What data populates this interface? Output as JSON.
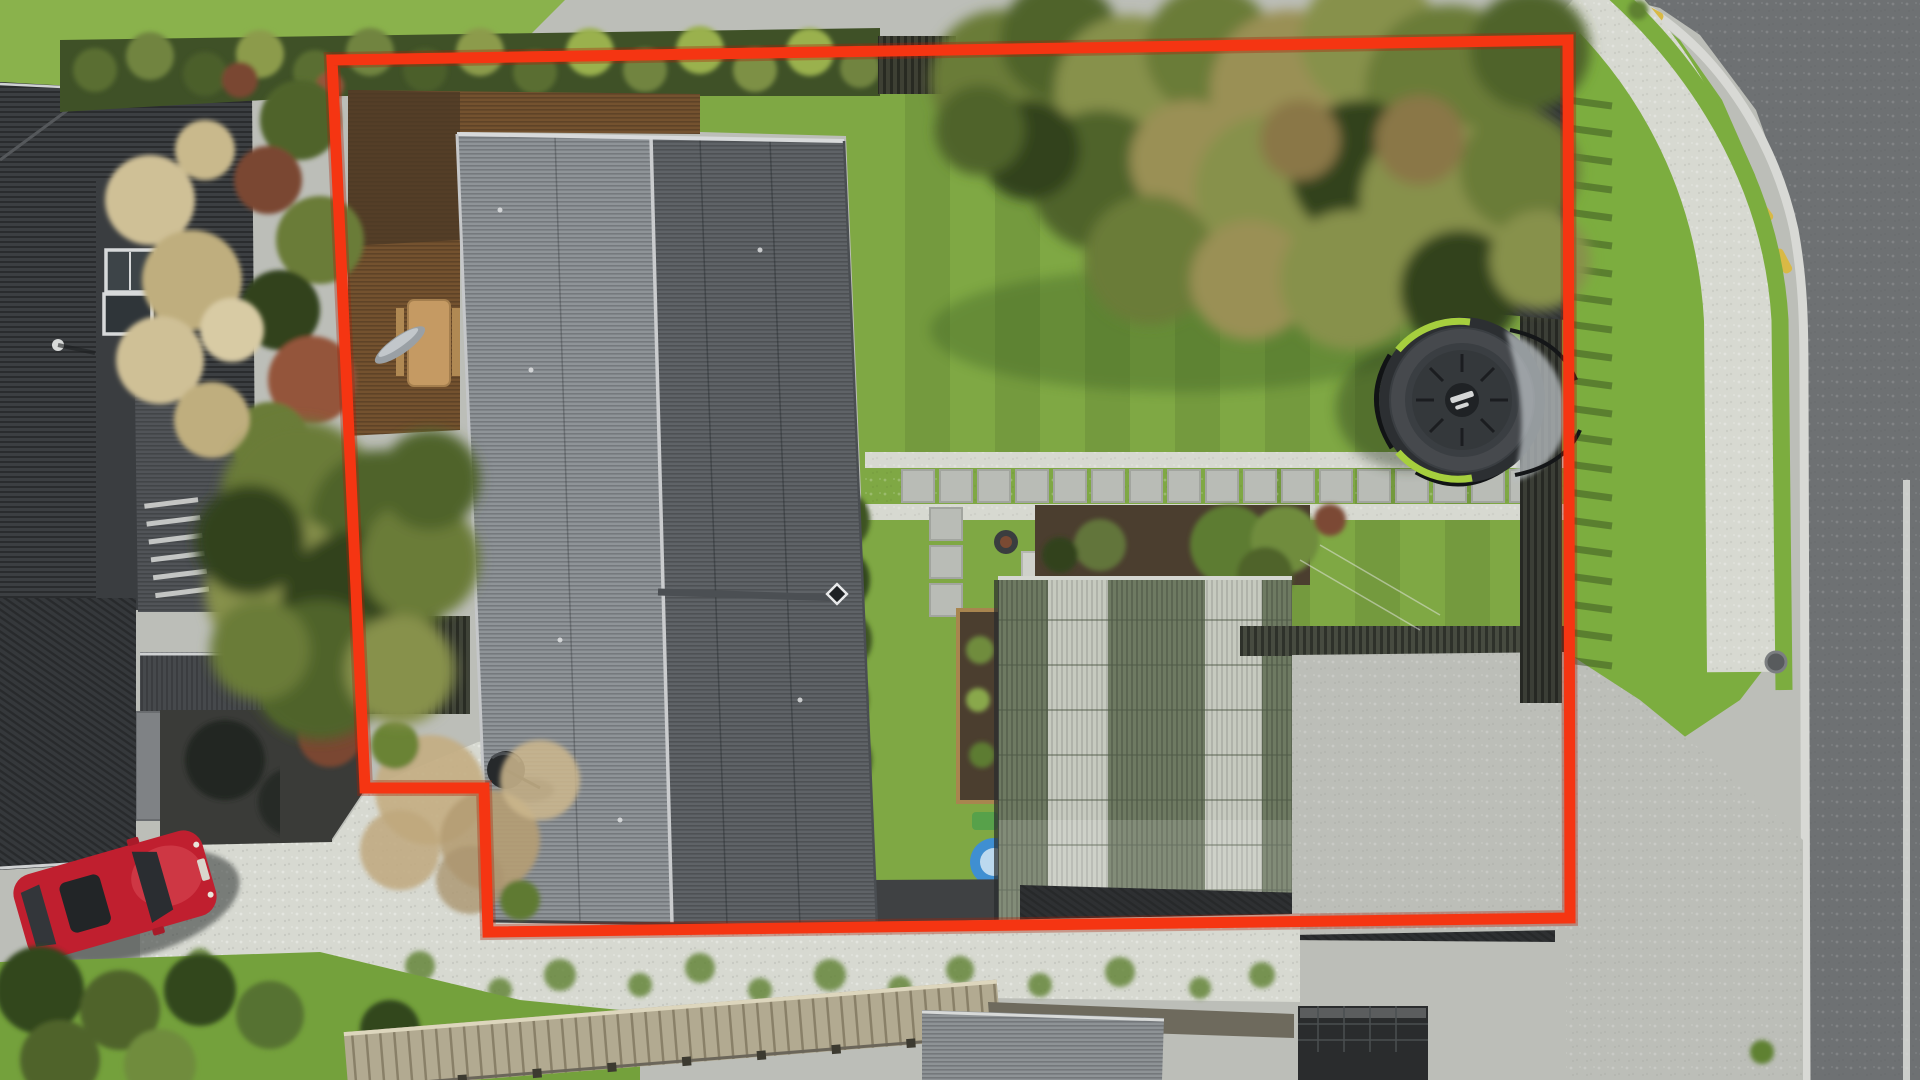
{
  "meta": {
    "type": "aerial-property-photo",
    "overlay": "red property boundary outline"
  },
  "palette": {
    "boundary_red": "#f53512",
    "boundary_glow": "#a81f06",
    "lawn": "#7fa844",
    "lawn_bright": "#8ab24c",
    "verge_grass": "#7cad3f",
    "road_asphalt": "#6e7173",
    "curb": "#d8d9d5",
    "road_marking_yellow": "#d9b945",
    "lane_line_white": "#dddedb",
    "concrete": "#bcbeb8",
    "gravel_white": "#d7d9d1",
    "roof_left_slope": "#8f9498",
    "roof_right_slope": "#5f6367",
    "neighbor_roof": "#3c3f42",
    "neighbor_roof_light": "#515458",
    "garage_green_roof": "#6e7a62",
    "skylight_panel": "#c6cabf",
    "deck_wood": "#74522f",
    "hedge_green": "#3f5127",
    "tree_green": "#62753a",
    "soil": "#4b3e2f",
    "car_red": "#c01f2f",
    "trampoline_body": "#34383b",
    "trampoline_accent": "#a6cf3e",
    "boardwalk_wood": "#b2aa91",
    "pool_blue": "#3f8fd2"
  },
  "boundary": {
    "path_d": "M332,60 L1568,40 L1570,918 L488,932 L484,788 L365,788 Z",
    "color": "#f53512",
    "glow": "#a81f06",
    "stroke_width": "11"
  }
}
